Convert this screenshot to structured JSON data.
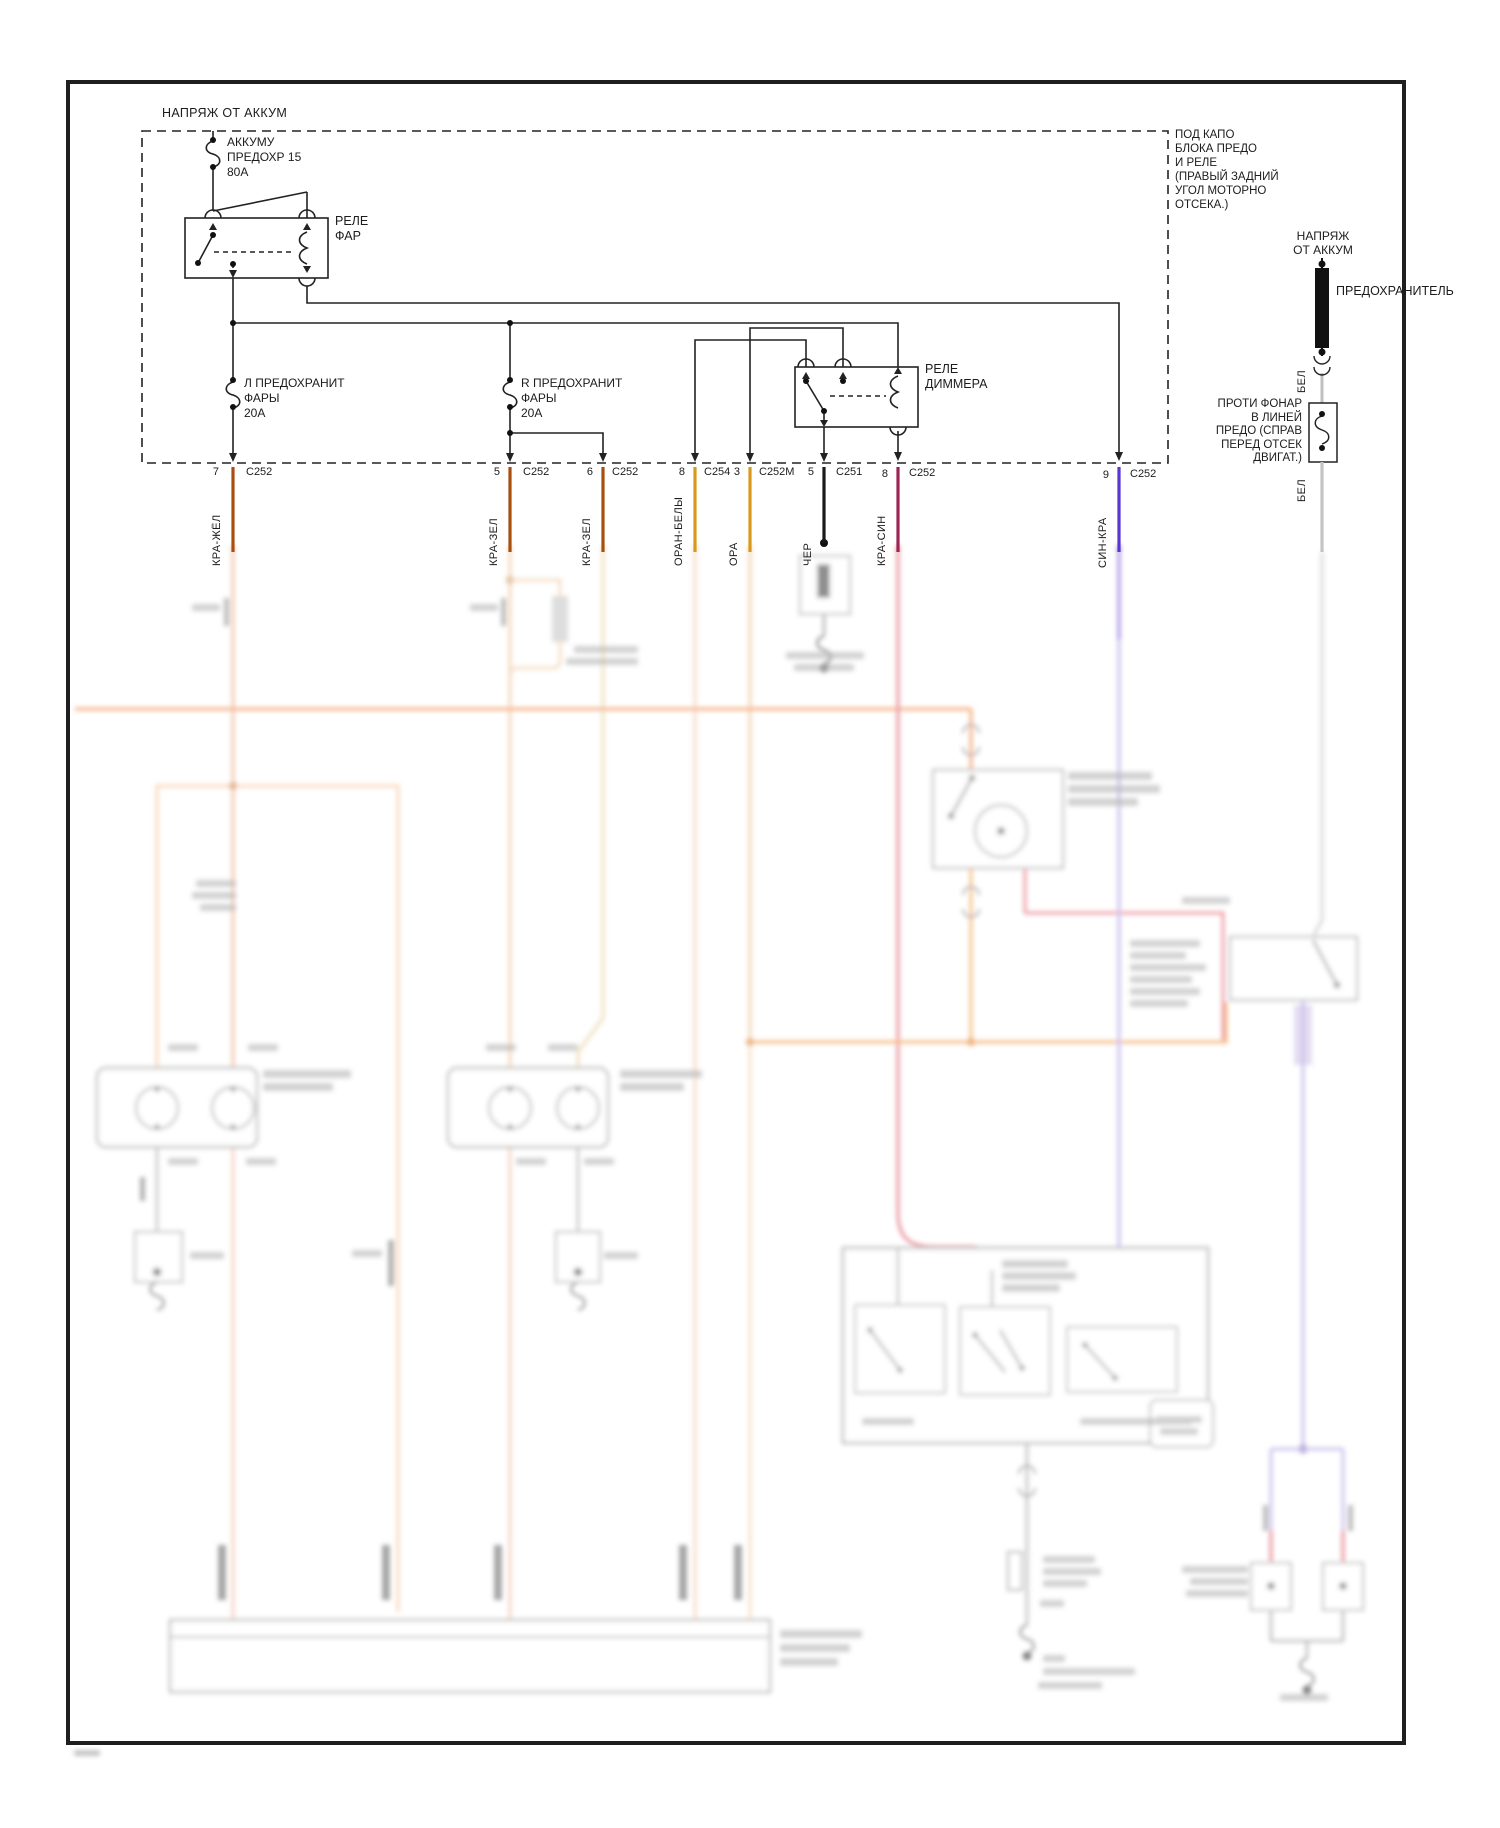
{
  "top": {
    "batt_feed_label": "НАПРЯЖ ОТ АККУМ",
    "fuse_batt": {
      "l1": "АККУМУ",
      "l2": "ПРЕДОХР 15",
      "l3": "80А"
    },
    "relay_headlamp": {
      "l1": "РЕЛЕ",
      "l2": "ФАР"
    },
    "fuse_left": {
      "l1": "Л ПРЕДОХРАНИТ",
      "l2": "ФАРЫ",
      "l3": "20А"
    },
    "fuse_right": {
      "l1": "R ПРЕДОХРАНИТ",
      "l2": "ФАРЫ",
      "l3": "20А"
    },
    "relay_dimmer": {
      "l1": "РЕЛЕ",
      "l2": "ДИММЕРА"
    },
    "underhood_note": {
      "l1": "ПОД КАПО",
      "l2": "БЛОКА ПРЕДО",
      "l3": "И РЕЛЕ",
      "l4": "(ПРАВЫЙ ЗАДНИЙ",
      "l5": "УГОЛ МОТОРНО",
      "l6": "ОТСЕКА.)"
    }
  },
  "right": {
    "batt_feed": {
      "l1": "НАПРЯЖ",
      "l2": "ОТ АККУМ"
    },
    "fuse_label": "ПРЕДОХРАНИТЕЛЬ",
    "wire_white_top": "БЕЛ",
    "fog_note": {
      "l1": "ПРОТИ ФОНАР",
      "l2": "В ЛИНЕЙ",
      "l3": "ПРЕДО (СПРАВ",
      "l4": "ПЕРЕД ОТСЕК",
      "l5": "ДВИГАТ.)"
    },
    "wire_white_bottom": "БЕЛ"
  },
  "connectors": [
    {
      "pin": "7",
      "name": "C252",
      "wire": "КРА-ЖЁЛ"
    },
    {
      "pin": "5",
      "name": "C252",
      "wire": "КРА-ЗЕЛ"
    },
    {
      "pin": "6",
      "name": "C252",
      "wire": "КРА-ЗЕЛ"
    },
    {
      "pin": "8",
      "name": "C254",
      "wire": "ОРАН-БЕЛЫ"
    },
    {
      "pin": "3",
      "name": "C252M",
      "wire": "ОРА"
    },
    {
      "pin": "5",
      "name": "C251",
      "wire": "ЧЕР"
    },
    {
      "pin": "8",
      "name": "C252",
      "wire": "КРА-СИН"
    },
    {
      "pin": "9",
      "name": "C252",
      "wire": "СИН-КРА"
    }
  ],
  "colors": {
    "wire_red_yellow": "#a84f10",
    "wire_orange": "#d9991a",
    "wire_black": "#1a1a1a",
    "wire_red_blue": "#9e2455",
    "wire_blue_red": "#5b35d2",
    "wire_white": "#c4c4c4",
    "routing_orange": "#f08c4a",
    "faded_peach": "#f5c9a2",
    "faded_red": "#e06070",
    "faded_lavender": "#b2a2e6"
  }
}
